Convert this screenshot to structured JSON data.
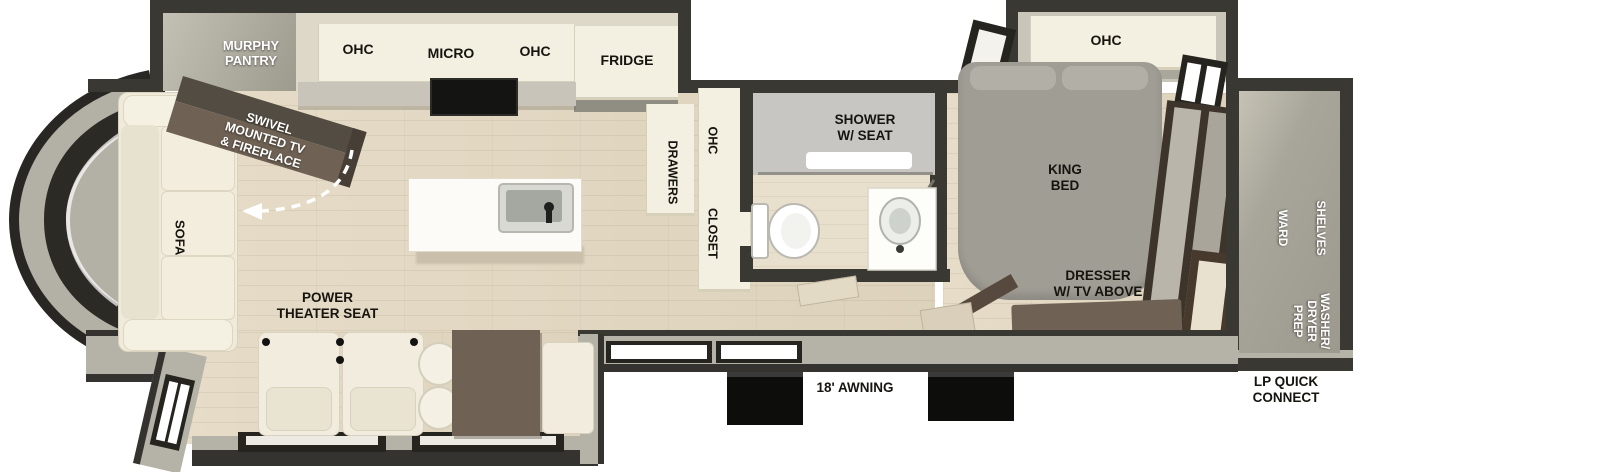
{
  "title": "Fifth Wheel RV Floorplan",
  "labels": {
    "murphy_pantry": "MURPHY\nPANTRY",
    "ohc_kitchen_left": "OHC",
    "micro": "MICRO",
    "ohc_kitchen_right": "OHC",
    "fridge": "FRIDGE",
    "swivel_tv": "SWIVEL\nMOUNTED TV\n& FIREPLACE",
    "sofa": "SOFA",
    "power_theater_seat": "POWER\nTHEATER SEAT",
    "drawers": "DRAWERS",
    "ohc_hall": "OHC",
    "closet": "CLOSET",
    "shower": "SHOWER\nW/ SEAT",
    "king_bed": "KING\nBED",
    "ohc_bedroom": "OHC",
    "dresser": "DRESSER\nW/ TV ABOVE",
    "ward": "WARD",
    "shelves": "SHELVES",
    "washer_dryer_prep": "WASHER/\nDRYER\nPREP",
    "awning": "18' AWNING",
    "lp_quick_connect": "LP QUICK\nCONNECT"
  },
  "colors": {
    "wall_dark": "#3a3833",
    "wall_gray": "#b5b2a7",
    "floor_wood": "#e2d8c3",
    "cabinet_cream": "#f3efe1",
    "furniture_brown": "#6f6254",
    "slide_interior": "#a8a59a",
    "bed_gray": "#a09d95",
    "label_dark": "#16140f",
    "label_white": "#ffffff"
  }
}
